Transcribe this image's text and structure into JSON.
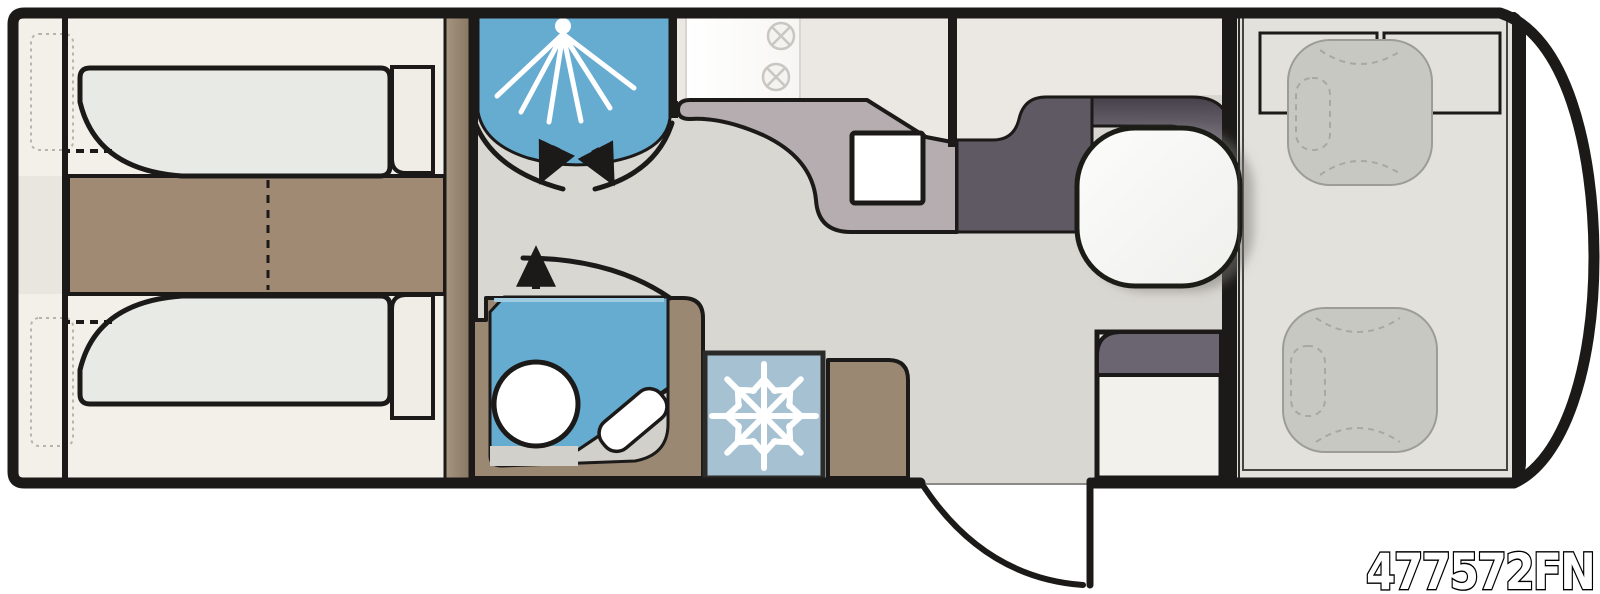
{
  "model_code": "477572FN",
  "icons": {
    "shower": "shower-spray-icon",
    "freezer": "snowflake-icon",
    "washroom_door": "door-swing-arc-icon",
    "shower_doors": "double-door-swing-icon",
    "entry_door": "door-swing-arc-icon",
    "hob": "burner-icon"
  },
  "colors": {
    "outline": "#1c1a18",
    "body_fill": "#ffffff",
    "floor": "#d9d7d1",
    "bedroom": "#f3f0ea",
    "headboard_band": "#e9e6e0",
    "mattress": "#e8eae6",
    "chest": "#f0ede7",
    "aisle_wood": "#a08a73",
    "wardrobe_from": "#a6957f",
    "wardrobe_to": "#887863",
    "wet_blue": "#66abd0",
    "wet_blue_light": "#9ecbe0",
    "washroom_wood": "#9b8873",
    "tray_gray": "#d2d0cb",
    "fridge_blue": "#a6c2d2",
    "fridge_border": "#2b2b29",
    "counter": "#b5adaf",
    "kitchen_cream": "#ebe8e3",
    "hob_glass": "#f7f6f3",
    "slate": "#5e5963",
    "bar_from": "#454049",
    "bar_to": "#8f8a96",
    "dinette_floor": "#e2e1db",
    "dinette_inner_line": "#45443f",
    "seat": "#c8c8c3",
    "seat_border": "#9d9d98",
    "seat_dash": "#a8a8a3",
    "table_white": "#fcfcfb",
    "table_shade": "#efefec",
    "bench_white": "#f3f1ec",
    "bench_top": "#6a6570",
    "door_edge_line": "#8a8a86",
    "window_dotted": "#b7b4ae",
    "burner": "#c9c7c1",
    "white": "#ffffff",
    "code_fill": "#ffffff",
    "code_stroke": "#000000"
  }
}
